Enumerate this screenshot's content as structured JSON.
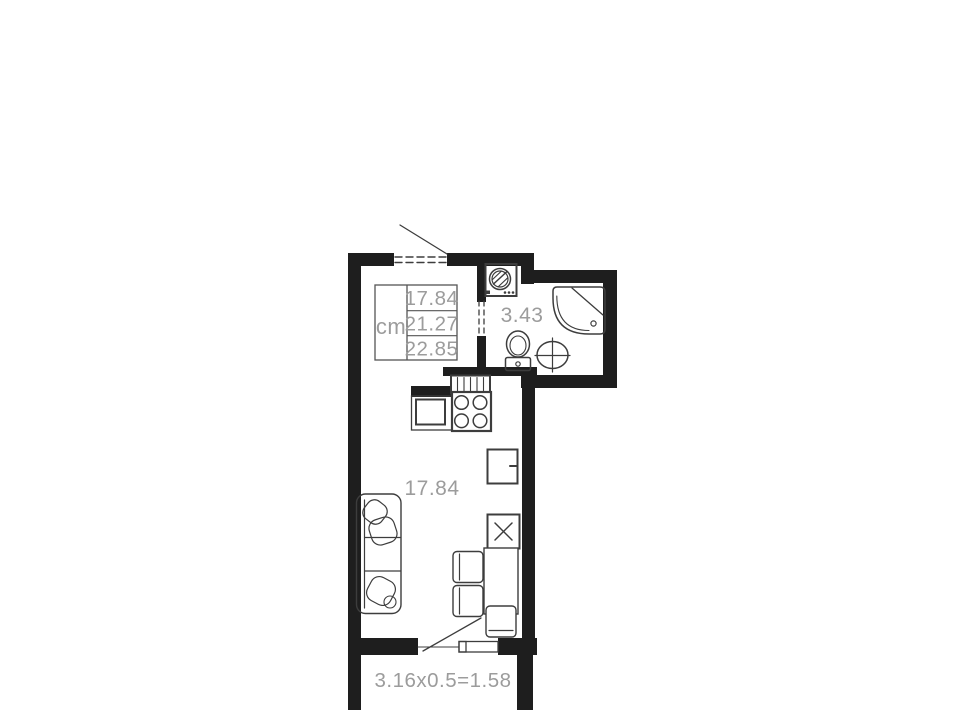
{
  "colors": {
    "wall": "#1e1e1e",
    "line": "#3d3d3d",
    "label": "#9c9c9c",
    "table_line": "#555555"
  },
  "area_table": {
    "unit": "cm",
    "values": [
      "17.84",
      "21.27",
      "22.85"
    ]
  },
  "rooms": {
    "bathroom": {
      "area": "3.43"
    },
    "living": {
      "area": "17.84"
    },
    "balcony": {
      "dimensions": "3.16x0.5=1.58"
    }
  },
  "fixtures": [
    "entrance-door",
    "washing-machine",
    "shower-cabin",
    "toilet",
    "bathroom-sink",
    "vent-shaft",
    "kitchen-counter",
    "kitchen-sink",
    "stove",
    "fridge",
    "shaft-box",
    "dining-table",
    "chairs",
    "sofa",
    "balcony-door"
  ]
}
